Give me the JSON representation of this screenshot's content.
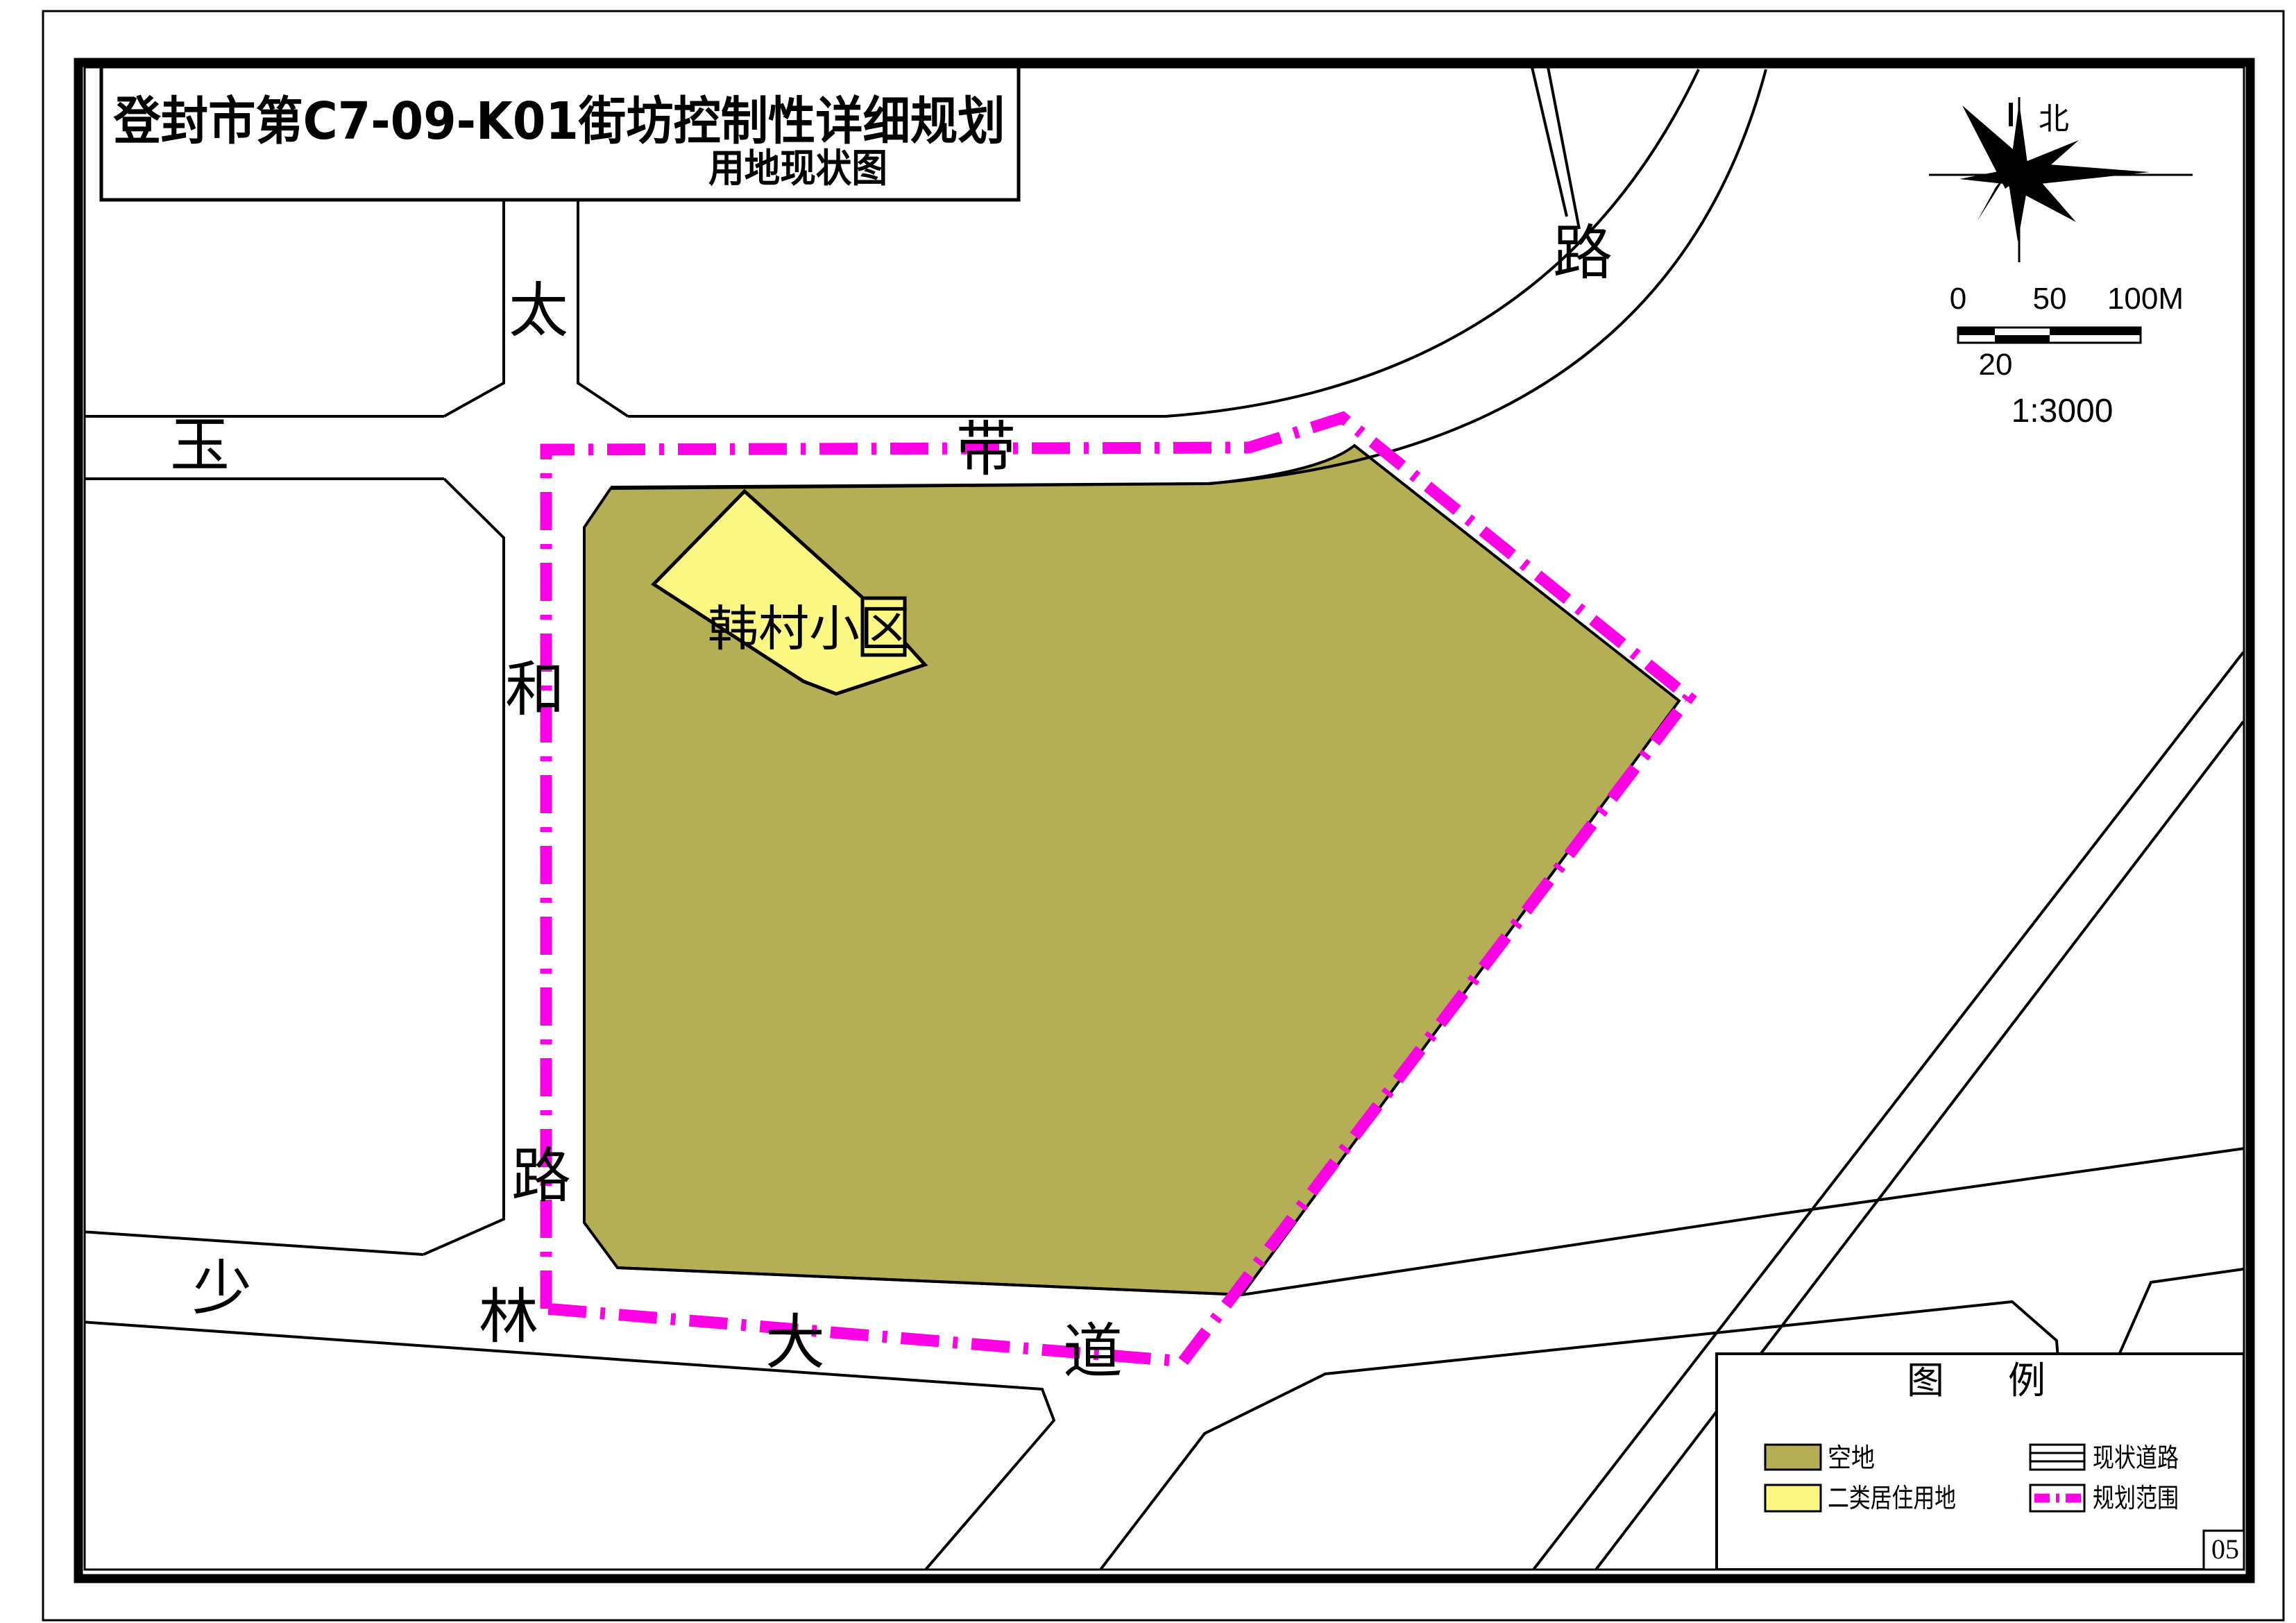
{
  "title_block": {
    "title": "登封市第C7-09-K01街坊控制性详细规划",
    "subtitle": "用地现状图"
  },
  "compass": {
    "north_label": "北"
  },
  "scale_bar": {
    "tick_0": "0",
    "tick_50": "50",
    "tick_100": "100M",
    "tick_20": "20",
    "ratio": "1:3000"
  },
  "map": {
    "site_label": "韩村小区",
    "road_labels": [
      {
        "text": "太"
      },
      {
        "text": "和"
      },
      {
        "text": "路"
      },
      {
        "text": "玉"
      },
      {
        "text": "带"
      },
      {
        "text": "路"
      },
      {
        "text": "少"
      },
      {
        "text": "林"
      },
      {
        "text": "大"
      },
      {
        "text": "道"
      }
    ]
  },
  "legend": {
    "title": "图例",
    "items": [
      {
        "label": "空地",
        "type": "area",
        "color": "#b4af55"
      },
      {
        "label": "二类居住用地",
        "type": "area",
        "color": "#faf782"
      },
      {
        "label": "现状道路",
        "type": "road-symbol"
      },
      {
        "label": "规划范围",
        "type": "boundary-symbol",
        "color": "#ff00e6"
      }
    ]
  },
  "page_number": "05",
  "colors": {
    "vacant_land": "#b4af55",
    "residential_land": "#faf782",
    "planning_boundary": "#ff00e6",
    "ink": "#000000",
    "paper": "#ffffff"
  }
}
